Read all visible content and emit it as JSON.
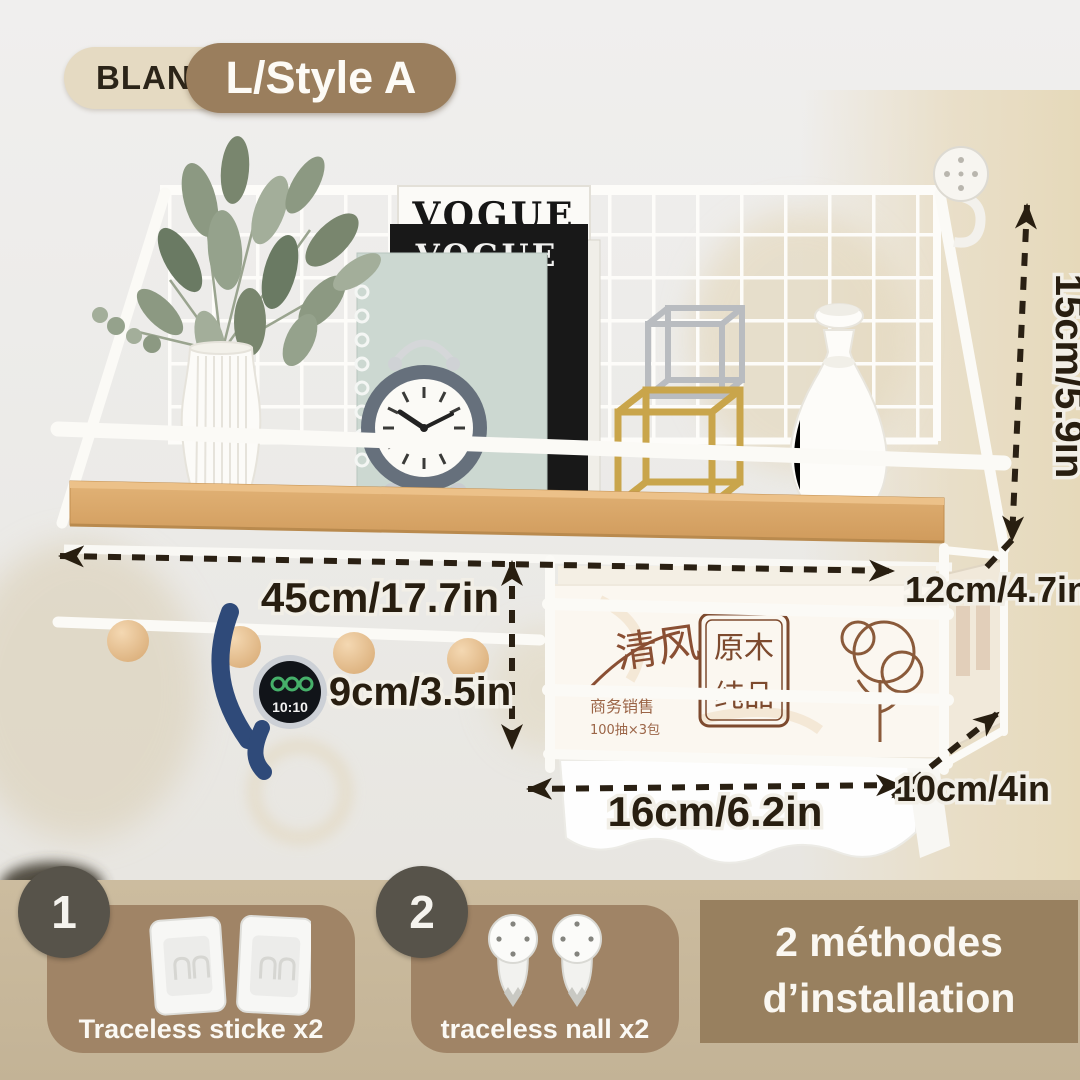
{
  "variant": {
    "color": "BLANC",
    "style": "L/Style A"
  },
  "dimensions": {
    "height": "15cm/5.9in",
    "width": "45cm/17.7in",
    "hook_drop": "9cm/3.5in",
    "rack_offset": "12cm/4.7in",
    "rack_width": "16cm/6.2in",
    "rack_depth": "10cm/4in"
  },
  "scene": {
    "magazine_back": "VOGUE",
    "magazine_front": "VOGUE",
    "watch_time": "10:10",
    "tissue_box": {
      "brand": "清风",
      "seal_top": "原木",
      "seal_bottom": "纯品",
      "line1": "商务销售",
      "line2": "100抽×3包"
    }
  },
  "installation": {
    "heading_line1": "2 méthodes",
    "heading_line2": "d’installation",
    "methods": [
      {
        "number": "1",
        "label": "Traceless sticke x2"
      },
      {
        "number": "2",
        "label": "traceless nall x2"
      }
    ]
  },
  "colors": {
    "badge_beige": "#e5dac2",
    "badge_brown": "#9a7e5d",
    "strip_tan": "#c8b89c",
    "card_brown": "#a08466",
    "circle_gray": "#57534a",
    "annotation_dark": "#281e10",
    "wood": "#d9a768",
    "wall_beige": "#e8dcc2"
  }
}
